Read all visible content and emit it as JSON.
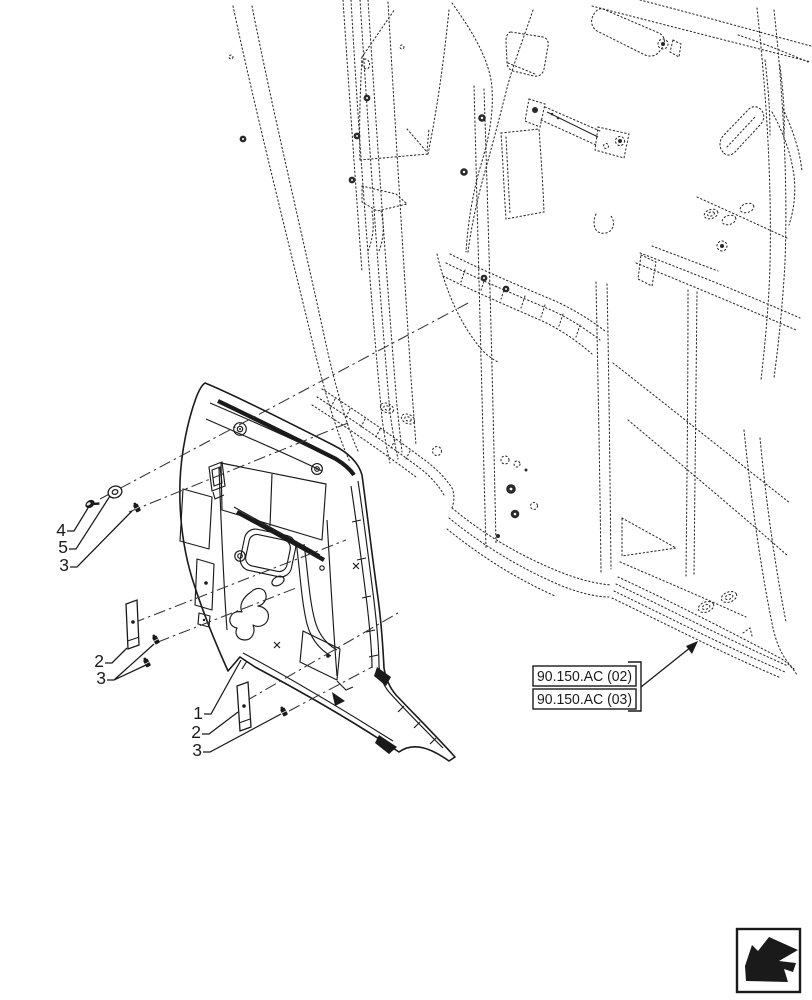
{
  "diagram": {
    "background": "#ffffff",
    "line_color": "#1a1a1a",
    "callouts": [
      {
        "label": "4"
      },
      {
        "label": "5"
      },
      {
        "label": "3"
      },
      {
        "label": "2"
      },
      {
        "label": "3"
      },
      {
        "label": "1"
      },
      {
        "label": "2"
      },
      {
        "label": "3"
      }
    ],
    "reference_boxes": [
      {
        "label": "90.150.AC (02)"
      },
      {
        "label": "90.150.AC (03)"
      }
    ],
    "icons": [
      {
        "name": "page-direction-arrow-icon"
      }
    ]
  }
}
